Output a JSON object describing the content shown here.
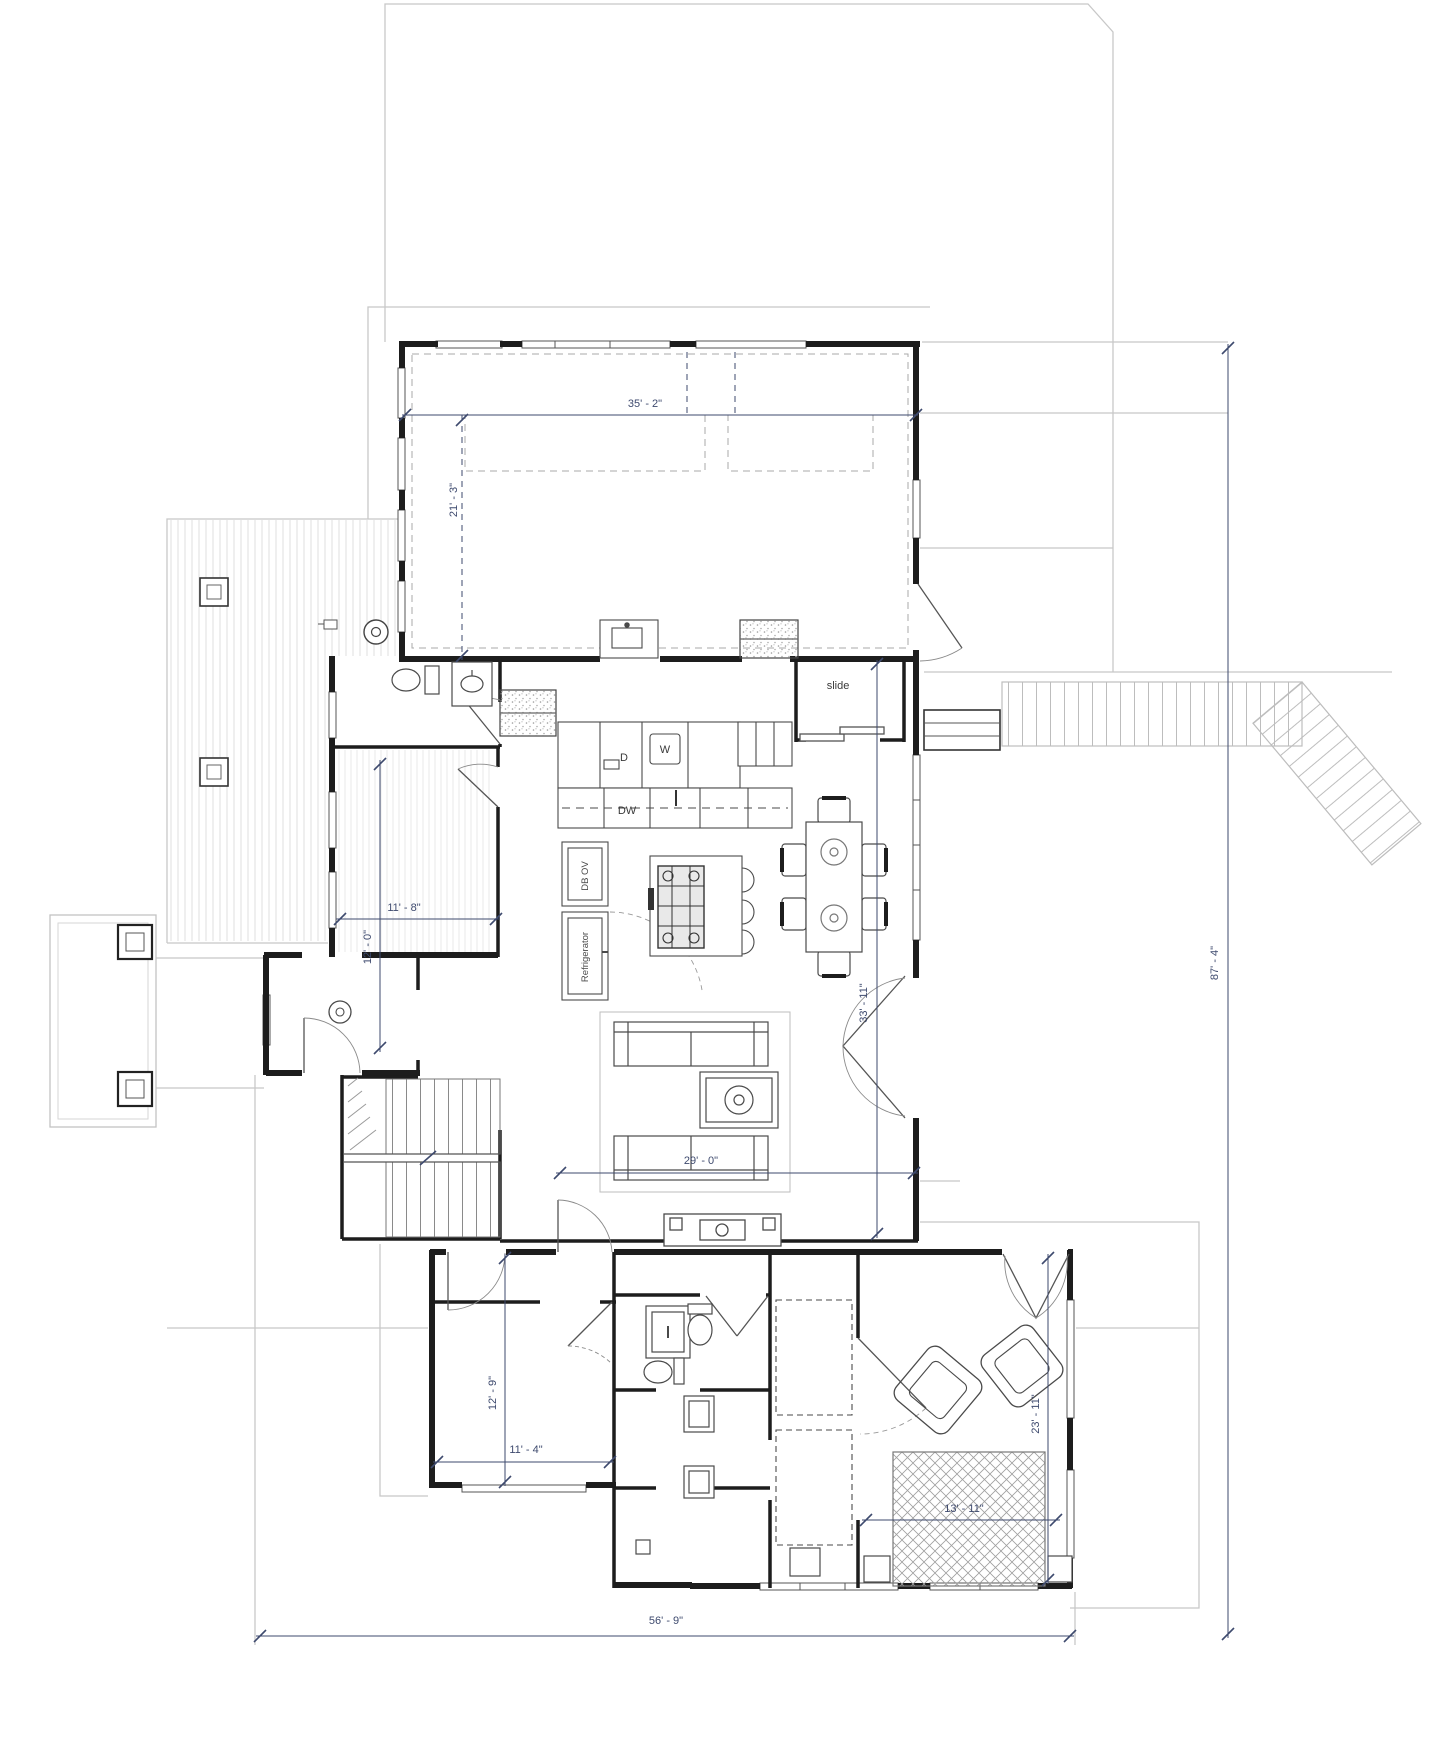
{
  "drawing": {
    "type": "architectural-floor-plan",
    "dimensions": {
      "great_room_width": "35' - 2\"",
      "great_room_depth": "21' - 3\"",
      "mudroom_depth": "12' - 0\"",
      "mudroom_width": "11' - 8\"",
      "main_block_depth": "33' - 11\"",
      "living_room_width": "29' - 0\"",
      "overall_depth": "87' - 4\"",
      "overall_width": "56' - 9\"",
      "bedroom_depth": "12' - 9\"",
      "bedroom_width": "11' - 4\"",
      "master_depth": "23' - 11\"",
      "master_rug_width": "13' - 11\""
    },
    "labels": {
      "slide": "slide",
      "dryer": "D",
      "washer": "W",
      "dishwasher": "DW",
      "double_oven": "DB OV",
      "refrigerator": "Refrigerator"
    },
    "colors": {
      "wall": "#1d1d1d",
      "dimension": "#3e4a6e",
      "site_line": "#c8c8c8",
      "detail": "#4a4a4a"
    }
  }
}
